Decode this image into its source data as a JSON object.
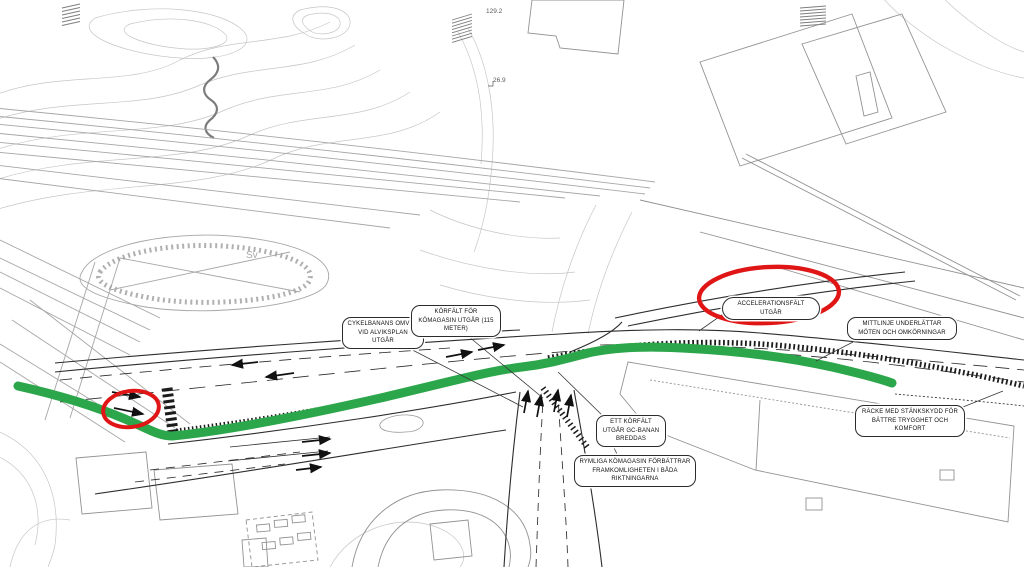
{
  "drawing": {
    "kind": "trafikplan",
    "language": "sv"
  },
  "colors": {
    "highlight_green": "#2ca64a",
    "marker_red": "#e01616"
  },
  "callouts": [
    {
      "id": "cykelbanans-omvag",
      "text": "CYKELBANANS OMVÄG VID ALVIKSPLAN UTGÅR"
    },
    {
      "id": "korfalt-komagasin",
      "text": "KÖRFÄLT FÖR KÖMAGASIN UTGÅR (115 METER)"
    },
    {
      "id": "accelerationsfalt",
      "text": "ACCELERATIONSFÄLT UTGÅR"
    },
    {
      "id": "mittlinje",
      "text": "MITTLINJE UNDERLÄTTAR MÖTEN OCH OMKÖRNINGAR"
    },
    {
      "id": "ett-korfalt",
      "text": "ETT KÖRFÄLT UTGÅR GC-BANAN BREDDAS"
    },
    {
      "id": "rymliga-komagasin",
      "text": "RYMLIGA KÖMAGASIN FÖRBÄTTRAR FRAMKOMLIGHETEN I BÅDA RIKTNINGARNA"
    },
    {
      "id": "racke-stankskydd",
      "text": "RÄCKE MED STÄNKSKYDD FÖR BÄTTRE TRYGGHET OCH KOMFORT"
    }
  ],
  "map_labels": [
    {
      "id": "elevation-1",
      "text": "129.2"
    },
    {
      "id": "elevation-2",
      "text": "26.9"
    },
    {
      "id": "track-switch",
      "text": "Sv"
    }
  ]
}
